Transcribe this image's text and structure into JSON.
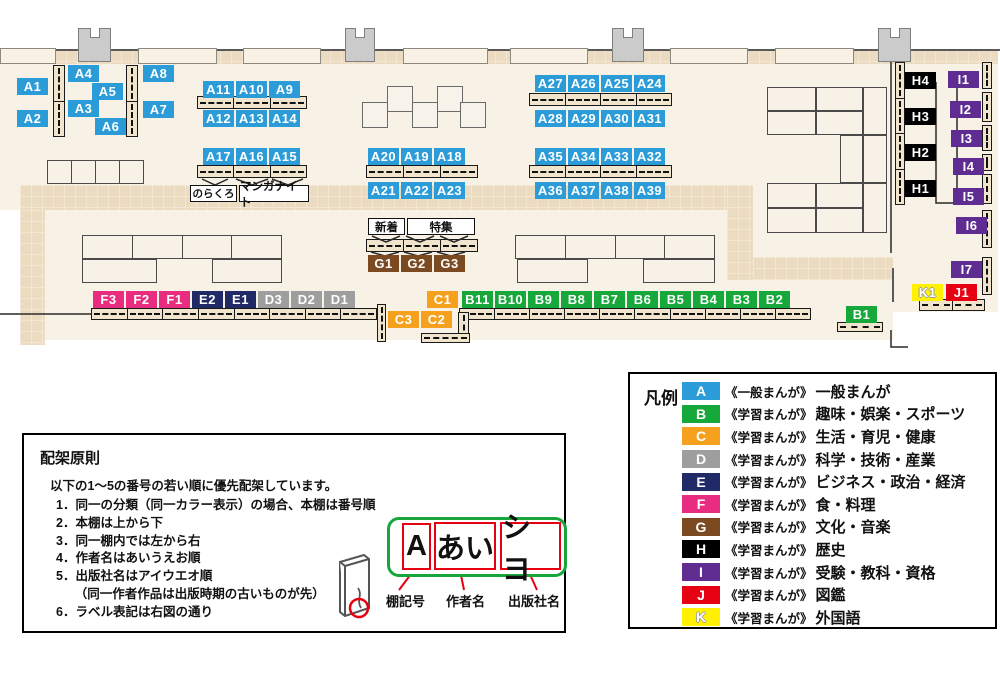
{
  "colors": {
    "A": "#2b9cd8",
    "B": "#17a83b",
    "C": "#f6a11d",
    "D": "#9e9e9f",
    "E": "#202a66",
    "F": "#e82d80",
    "G": "#7b4a21",
    "H": "#000000",
    "I": "#5f2d91",
    "J": "#e60012",
    "K": "#fff100"
  },
  "map": {
    "labels": [
      {
        "t": "A1",
        "c": "A",
        "x": 17,
        "y": 78
      },
      {
        "t": "A2",
        "c": "A",
        "x": 17,
        "y": 110
      },
      {
        "t": "A4",
        "c": "A",
        "x": 68,
        "y": 65
      },
      {
        "t": "A5",
        "c": "A",
        "x": 92,
        "y": 83
      },
      {
        "t": "A3",
        "c": "A",
        "x": 68,
        "y": 100
      },
      {
        "t": "A6",
        "c": "A",
        "x": 95,
        "y": 118
      },
      {
        "t": "A8",
        "c": "A",
        "x": 143,
        "y": 65
      },
      {
        "t": "A7",
        "c": "A",
        "x": 143,
        "y": 101
      },
      {
        "t": "A11",
        "c": "A",
        "x": 203,
        "y": 81
      },
      {
        "t": "A10",
        "c": "A",
        "x": 236,
        "y": 81
      },
      {
        "t": "A9",
        "c": "A",
        "x": 269,
        "y": 81
      },
      {
        "t": "A12",
        "c": "A",
        "x": 203,
        "y": 110
      },
      {
        "t": "A13",
        "c": "A",
        "x": 236,
        "y": 110
      },
      {
        "t": "A14",
        "c": "A",
        "x": 269,
        "y": 110
      },
      {
        "t": "A17",
        "c": "A",
        "x": 203,
        "y": 148
      },
      {
        "t": "A16",
        "c": "A",
        "x": 236,
        "y": 148
      },
      {
        "t": "A15",
        "c": "A",
        "x": 269,
        "y": 148
      },
      {
        "t": "A20",
        "c": "A",
        "x": 368,
        "y": 148
      },
      {
        "t": "A19",
        "c": "A",
        "x": 401,
        "y": 148
      },
      {
        "t": "A18",
        "c": "A",
        "x": 434,
        "y": 148
      },
      {
        "t": "A21",
        "c": "A",
        "x": 368,
        "y": 182
      },
      {
        "t": "A22",
        "c": "A",
        "x": 401,
        "y": 182
      },
      {
        "t": "A23",
        "c": "A",
        "x": 434,
        "y": 182
      },
      {
        "t": "A27",
        "c": "A",
        "x": 535,
        "y": 75
      },
      {
        "t": "A26",
        "c": "A",
        "x": 568,
        "y": 75
      },
      {
        "t": "A25",
        "c": "A",
        "x": 601,
        "y": 75
      },
      {
        "t": "A24",
        "c": "A",
        "x": 634,
        "y": 75
      },
      {
        "t": "A28",
        "c": "A",
        "x": 535,
        "y": 110
      },
      {
        "t": "A29",
        "c": "A",
        "x": 568,
        "y": 110
      },
      {
        "t": "A30",
        "c": "A",
        "x": 601,
        "y": 110
      },
      {
        "t": "A31",
        "c": "A",
        "x": 634,
        "y": 110
      },
      {
        "t": "A35",
        "c": "A",
        "x": 535,
        "y": 148
      },
      {
        "t": "A34",
        "c": "A",
        "x": 568,
        "y": 148
      },
      {
        "t": "A33",
        "c": "A",
        "x": 601,
        "y": 148
      },
      {
        "t": "A32",
        "c": "A",
        "x": 634,
        "y": 148
      },
      {
        "t": "A36",
        "c": "A",
        "x": 535,
        "y": 182
      },
      {
        "t": "A37",
        "c": "A",
        "x": 568,
        "y": 182
      },
      {
        "t": "A38",
        "c": "A",
        "x": 601,
        "y": 182
      },
      {
        "t": "A39",
        "c": "A",
        "x": 634,
        "y": 182
      },
      {
        "t": "G1",
        "c": "G",
        "x": 368,
        "y": 255
      },
      {
        "t": "G2",
        "c": "G",
        "x": 401,
        "y": 255
      },
      {
        "t": "G3",
        "c": "G",
        "x": 434,
        "y": 255
      },
      {
        "t": "F3",
        "c": "F",
        "x": 93,
        "y": 291
      },
      {
        "t": "F2",
        "c": "F",
        "x": 126,
        "y": 291
      },
      {
        "t": "F1",
        "c": "F",
        "x": 159,
        "y": 291
      },
      {
        "t": "E2",
        "c": "E",
        "x": 192,
        "y": 291
      },
      {
        "t": "E1",
        "c": "E",
        "x": 225,
        "y": 291
      },
      {
        "t": "D3",
        "c": "D",
        "x": 258,
        "y": 291
      },
      {
        "t": "D2",
        "c": "D",
        "x": 291,
        "y": 291
      },
      {
        "t": "D1",
        "c": "D",
        "x": 324,
        "y": 291
      },
      {
        "t": "C1",
        "c": "C",
        "x": 427,
        "y": 291
      },
      {
        "t": "C3",
        "c": "C",
        "x": 388,
        "y": 311
      },
      {
        "t": "C2",
        "c": "C",
        "x": 421,
        "y": 311
      },
      {
        "t": "B11",
        "c": "B",
        "x": 462,
        "y": 291
      },
      {
        "t": "B10",
        "c": "B",
        "x": 495,
        "y": 291
      },
      {
        "t": "B9",
        "c": "B",
        "x": 528,
        "y": 291
      },
      {
        "t": "B8",
        "c": "B",
        "x": 561,
        "y": 291
      },
      {
        "t": "B7",
        "c": "B",
        "x": 594,
        "y": 291
      },
      {
        "t": "B6",
        "c": "B",
        "x": 627,
        "y": 291
      },
      {
        "t": "B5",
        "c": "B",
        "x": 660,
        "y": 291
      },
      {
        "t": "B4",
        "c": "B",
        "x": 693,
        "y": 291
      },
      {
        "t": "B3",
        "c": "B",
        "x": 726,
        "y": 291
      },
      {
        "t": "B2",
        "c": "B",
        "x": 759,
        "y": 291
      },
      {
        "t": "B1",
        "c": "B",
        "x": 846,
        "y": 306
      },
      {
        "t": "H4",
        "c": "H",
        "x": 905,
        "y": 72
      },
      {
        "t": "H3",
        "c": "H",
        "x": 905,
        "y": 108
      },
      {
        "t": "H2",
        "c": "H",
        "x": 905,
        "y": 144
      },
      {
        "t": "H1",
        "c": "H",
        "x": 905,
        "y": 180
      },
      {
        "t": "I1",
        "c": "I",
        "x": 948,
        "y": 71
      },
      {
        "t": "I2",
        "c": "I",
        "x": 950,
        "y": 101
      },
      {
        "t": "I3",
        "c": "I",
        "x": 951,
        "y": 130
      },
      {
        "t": "I4",
        "c": "I",
        "x": 953,
        "y": 158
      },
      {
        "t": "I5",
        "c": "I",
        "x": 953,
        "y": 188
      },
      {
        "t": "I6",
        "c": "I",
        "x": 956,
        "y": 217
      },
      {
        "t": "I7",
        "c": "I",
        "x": 951,
        "y": 261
      },
      {
        "t": "K1",
        "c": "K",
        "x": 912,
        "y": 284
      },
      {
        "t": "J1",
        "c": "J",
        "x": 946,
        "y": 284
      }
    ],
    "notes": {
      "norakuro": "のらくろ",
      "manganight": "マンガナイト",
      "new_arrivals": "新着",
      "feature": "特集"
    }
  },
  "legend": {
    "title": "凡例",
    "items": [
      {
        "code": "A",
        "series": "《一般まんが》",
        "category": "一般まんが"
      },
      {
        "code": "B",
        "series": "《学習まんが》",
        "category": "趣味・娯楽・スポーツ"
      },
      {
        "code": "C",
        "series": "《学習まんが》",
        "category": "生活・育児・健康"
      },
      {
        "code": "D",
        "series": "《学習まんが》",
        "category": "科学・技術・産業"
      },
      {
        "code": "E",
        "series": "《学習まんが》",
        "category": "ビジネス・政治・経済"
      },
      {
        "code": "F",
        "series": "《学習まんが》",
        "category": "食・料理"
      },
      {
        "code": "G",
        "series": "《学習まんが》",
        "category": "文化・音楽"
      },
      {
        "code": "H",
        "series": "《学習まんが》",
        "category": "歴史"
      },
      {
        "code": "I",
        "series": "《学習まんが》",
        "category": "受験・教科・資格"
      },
      {
        "code": "J",
        "series": "《学習まんが》",
        "category": "図鑑"
      },
      {
        "code": "K",
        "series": "《学習まんが》",
        "category": "外国語"
      }
    ]
  },
  "principles": {
    "title": "配架原則",
    "intro": "以下の1～5の番号の若い順に優先配架しています。",
    "items": [
      "1．同一の分類（同一カラー表示）の場合、本棚は番号順",
      "2．本棚は上から下",
      "3．同一棚内では左から右",
      "4．作者名はあいうえお順",
      "5．出版社名はアイウエオ順",
      "　　（同一作者作品は出版時期の古いものが先）",
      "6．ラベル表記は右図の通り"
    ]
  },
  "label_diagram": {
    "boxes": [
      {
        "text": "A",
        "caption": "棚記号"
      },
      {
        "text": "あい",
        "caption": "作者名"
      },
      {
        "text": "シヨ",
        "caption": "出版社名"
      }
    ]
  }
}
